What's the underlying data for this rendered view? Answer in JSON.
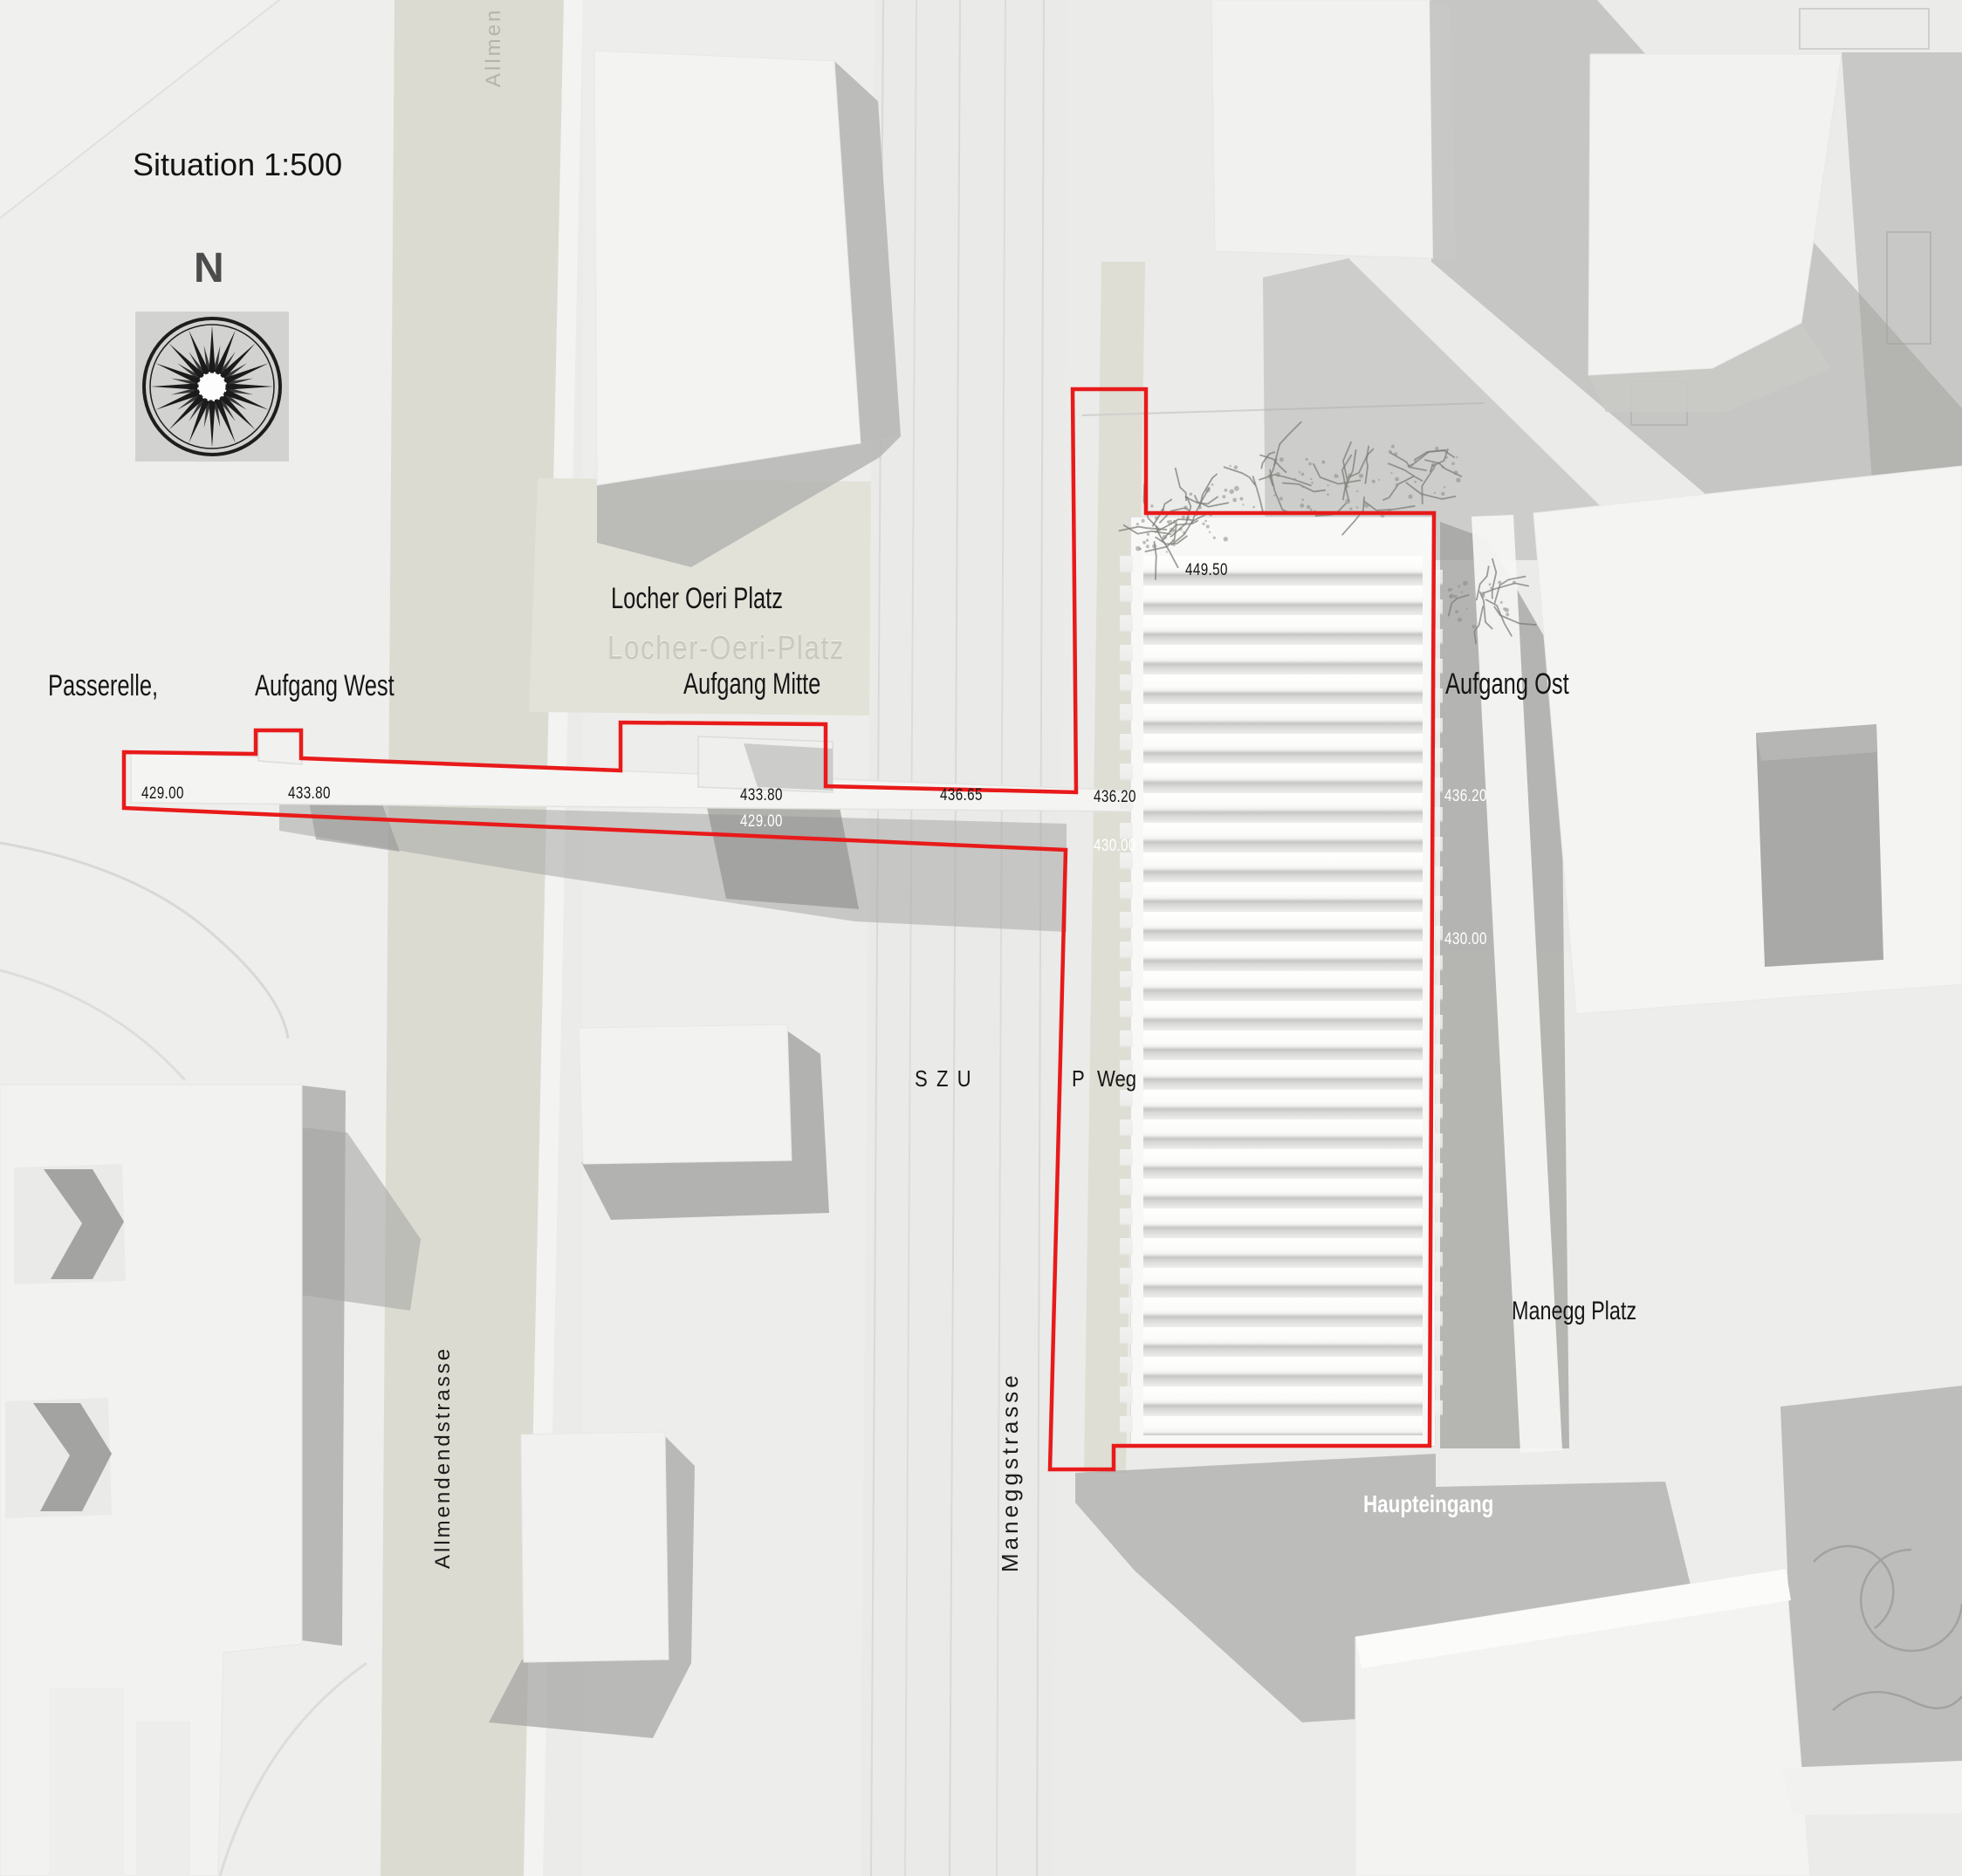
{
  "title": "Situation 1:500",
  "compass": {
    "label": "N"
  },
  "streets": {
    "allmendendstrasse": "Allmendendstrasse",
    "allmendendstrasse_partial": "Allmen",
    "maneggstrasse": "Maneggstrasse",
    "szu": "SZU",
    "p_weg": "P Weg"
  },
  "places": {
    "locher_oeri_platz": "Locher Oeri Platz",
    "locher_oeri_platz_engraved": "Locher-Oeri-Platz",
    "manegg_platz": "Manegg Platz"
  },
  "project": {
    "passerelle": "Passerelle,",
    "aufgang_west": "Aufgang West",
    "aufgang_mitte": "Aufgang Mitte",
    "aufgang_ost": "Aufgang Ost",
    "haupteingang": "Haupteingang"
  },
  "elevations": [
    {
      "value": "429.00",
      "tone": "dark"
    },
    {
      "value": "433.80",
      "tone": "dark"
    },
    {
      "value": "433.80",
      "tone": "dark"
    },
    {
      "value": "429.00",
      "tone": "light"
    },
    {
      "value": "436.65",
      "tone": "dark"
    },
    {
      "value": "436.20",
      "tone": "dark"
    },
    {
      "value": "430.00",
      "tone": "light"
    },
    {
      "value": "449.50",
      "tone": "dark"
    },
    {
      "value": "436.20",
      "tone": "light"
    },
    {
      "value": "430.00",
      "tone": "light"
    }
  ],
  "colors": {
    "outline_red": "#e81a1a",
    "street_beige": "#dcdbd1",
    "text_dark": "#161616",
    "text_light": "#ffffff"
  }
}
